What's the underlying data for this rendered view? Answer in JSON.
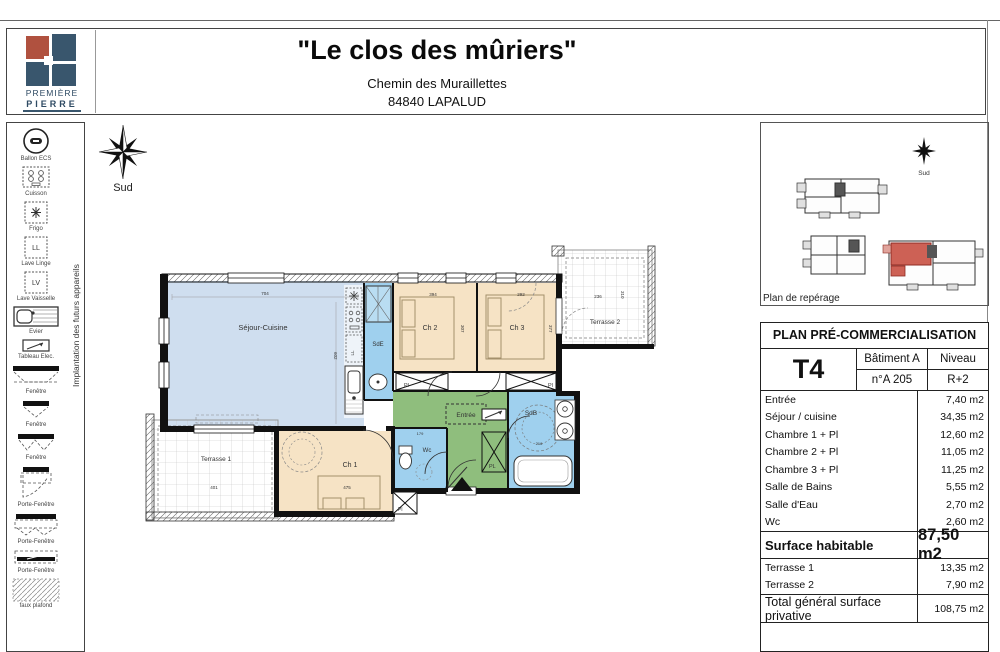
{
  "header": {
    "title": "\"Le clos des  mûriers\"",
    "address_line1": "Chemin des Muraillettes",
    "address_line2": "84840 LAPALUD",
    "logo_line1": "PREMIÈRE",
    "logo_line2": "PIERRE"
  },
  "compass": {
    "label": "Sud"
  },
  "sidebar": {
    "vertical_label": "Implantation des futurs appareils",
    "items": [
      {
        "label": "Ballon ECS"
      },
      {
        "label": "Cuisson"
      },
      {
        "label": "Frigo"
      },
      {
        "label": "Lave Linge",
        "icon_text": "LL"
      },
      {
        "label": "Lave Vaisselle",
        "icon_text": "LV"
      },
      {
        "label": "Evier"
      },
      {
        "label": "Tableau Elec."
      },
      {
        "label": "Fenêtre"
      },
      {
        "label": "Fenêtre"
      },
      {
        "label": "Fenêtre"
      },
      {
        "label": "Porte-Fenêtre"
      },
      {
        "label": "Porte-Fenêtre"
      },
      {
        "label": "Porte-Fenêtre"
      },
      {
        "label": "faux plafond"
      }
    ]
  },
  "plan": {
    "rooms": {
      "sejour": "Séjour-Cuisine",
      "sde": "SdE",
      "ch1": "Ch 1",
      "ch2": "Ch 2",
      "ch3": "Ch 3",
      "wc": "Wc",
      "entree": "Entrée",
      "sdb": "SdB",
      "terrasse1": "Terrasse 1",
      "terrasse2": "Terrasse 2"
    },
    "closets": {
      "pl_ch2": "Pl",
      "pl_ch3": "Pl",
      "pl_entree": "PL",
      "pl_wc": "Pl"
    },
    "appliance_labels": {
      "ll": "LL"
    },
    "dims": {
      "sejour_w": "704",
      "sejour_h": "602",
      "ch2_w": "394",
      "ch2_h": "307",
      "ch3_w": "292",
      "ch3_h": "377",
      "terrasse2_w": "236",
      "terrasse2_h": "310",
      "terrasse1_w": "401",
      "ch1_w": "475",
      "wc_w": "179",
      "sdb_w": "216"
    }
  },
  "minimap": {
    "caption": "Plan de repérage",
    "compass_label": "Sud"
  },
  "table": {
    "title": "PLAN PRÉ-COMMERCIALISATION",
    "type_label": "T4",
    "batiment": "Bâtiment A",
    "lot": "n°A 205",
    "niveau_label": "Niveau",
    "niveau_value": "R+2",
    "rooms": [
      {
        "label": "Entrée",
        "value": "7,40 m2"
      },
      {
        "label": "Séjour / cuisine",
        "value": "34,35 m2"
      },
      {
        "label": "Chambre 1 + Pl",
        "value": "12,60 m2"
      },
      {
        "label": "Chambre 2 + Pl",
        "value": "11,05 m2"
      },
      {
        "label": "Chambre 3 + Pl",
        "value": "11,25 m2"
      },
      {
        "label": "Salle de Bains",
        "value": "5,55 m2"
      },
      {
        "label": "Salle d'Eau",
        "value": "2,70 m2"
      },
      {
        "label": "Wc",
        "value": "2,60 m2"
      }
    ],
    "surface": {
      "label": "Surface habitable",
      "value": "87,50 m2"
    },
    "terrasses": [
      {
        "label": "Terrasse 1",
        "value": "13,35 m2"
      },
      {
        "label": "Terrasse 2",
        "value": "7,90 m2"
      }
    ],
    "total": {
      "label": "Total général surface privative",
      "value": "108,75 m2"
    }
  }
}
